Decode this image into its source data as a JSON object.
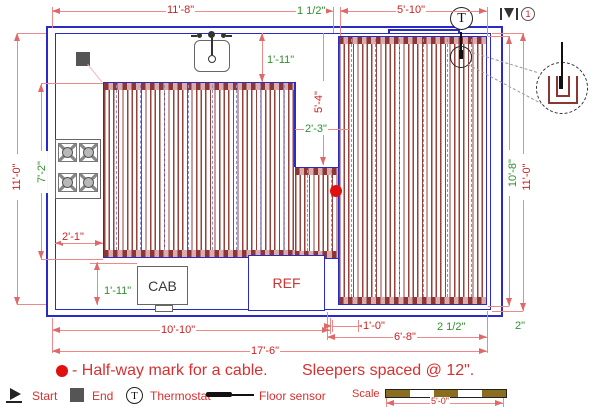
{
  "plan": {
    "room_labels": {
      "cab": "CAB",
      "ref": "REF"
    },
    "thermostat_letter": "T",
    "cable_number": "1",
    "dims": {
      "top_width": "11'-8\"",
      "top_offset": "1 1/2\"",
      "top_right_width": "5'-10\"",
      "left_height": "11'-0\"",
      "heated_left_height": "7'-2\"",
      "counter_depth": "1'-11\"",
      "notch_height": "5'-4\"",
      "notch_width": "2'-3\"",
      "stove_gap": "2'-1\"",
      "cab_depth": "1'-11\"",
      "bottom_left_width": "10'-10\"",
      "total_width": "17'-6\"",
      "ref_gap": "1'-0\"",
      "bottom_right_width": "6'-8\"",
      "right_edge_gap": "2 1/2\"",
      "bottom_edge_gap": "2\"",
      "heated_right_height": "10'-8\"",
      "right_height": "11'-0\""
    }
  },
  "legend": {
    "halfway_note": "- Half-way mark for a cable.",
    "sleepers_note": "Sleepers spaced @ 12\".",
    "start_label": "Start",
    "end_label": "End",
    "thermostat_label": "Thermostat",
    "floor_sensor_label": "Floor sensor",
    "scale_label": "Scale",
    "scale_length": "5'-0\""
  },
  "colors": {
    "wall_blue": "#2a2ac8",
    "dimension_red": "#cc2222",
    "dimension_green": "#2f8f2f",
    "cable": "#96413b",
    "sleeper": "#8d8dd8",
    "halfway_dot": "#e01010",
    "scale_bar": "#8a6d1c"
  }
}
